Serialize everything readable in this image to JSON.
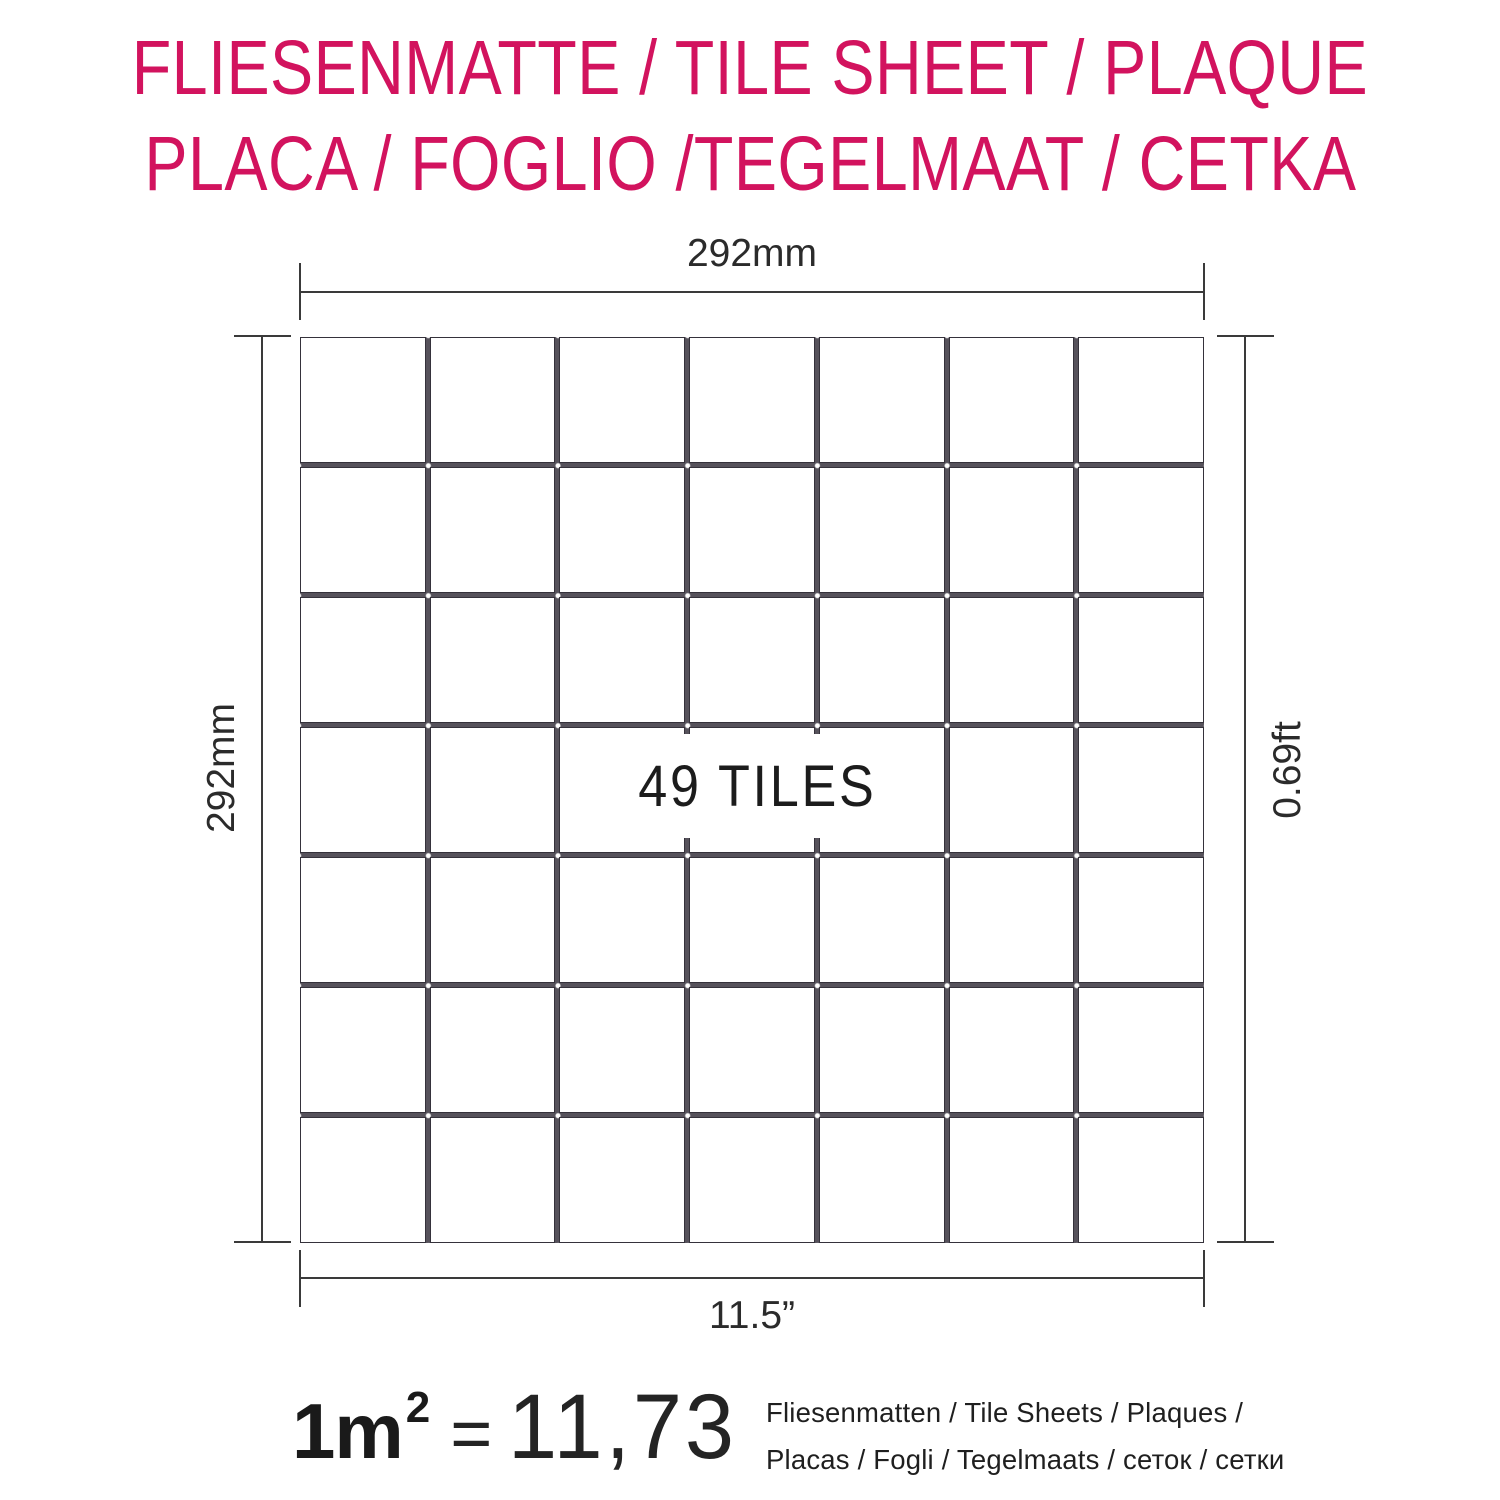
{
  "colors": {
    "accent_pink": "#D2135E",
    "dim_line": "#3A3A3A",
    "grout": "#56525B",
    "tile_border": "#35323B",
    "text": "#1C1C1C"
  },
  "title": {
    "line1": "FLIESENMATTE / TILE SHEET / PLAQUE",
    "line2": "PLACA / FOGLIO /TEGELMAAT / CETKA"
  },
  "sheet": {
    "rows": 7,
    "cols": 7,
    "tile_count_label": "49 TILES"
  },
  "dimensions": {
    "top": "292mm",
    "left": "292mm",
    "right": "0.69ft",
    "bottom": "11.5”"
  },
  "formula": {
    "area": "1m",
    "exponent": "2",
    "equals": "=",
    "value": "11,73",
    "caption_line1": "Fliesenmatten / Tile Sheets /  Plaques /",
    "caption_line2": "Placas / Fogli / Tegelmaats / сеток / сетки"
  }
}
